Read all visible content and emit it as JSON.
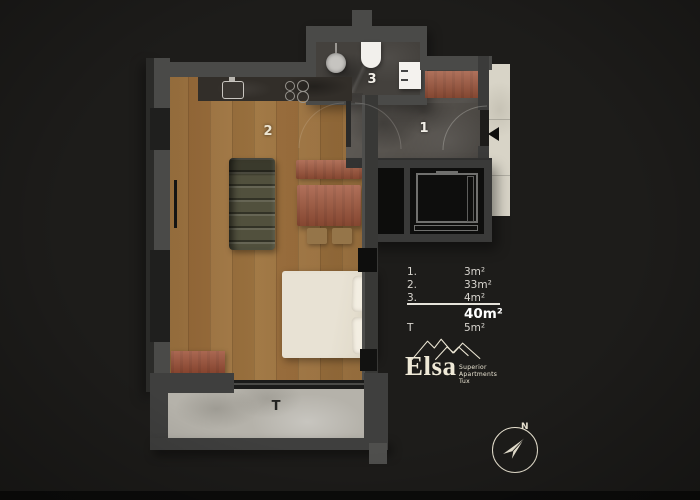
{
  "floor_plan": {
    "room_labels": {
      "hallway": "1",
      "living_area": "2",
      "bathroom": "3",
      "terrace": "T"
    }
  },
  "legend": {
    "rows": [
      {
        "key": "1.",
        "value": "3m²"
      },
      {
        "key": "2.",
        "value": "33m²"
      },
      {
        "key": "3.",
        "value": "4m²"
      }
    ],
    "total_value": "40m²",
    "terrace_row": {
      "key": "T",
      "value": "5m²"
    }
  },
  "logo": {
    "name": "Elsa",
    "tagline_line1": "Superior",
    "tagline_line2": "Apartments",
    "tagline_line3": "Tux"
  },
  "compass": {
    "north_label": "N"
  },
  "colors": {
    "background": "#1d1c1a",
    "wood_floor": "#c8ac81",
    "stone_floor": "#56524d",
    "terrace_floor": "#b5b2aa",
    "furniture_accent": "#a2563b",
    "cream": "#ece6d4"
  }
}
